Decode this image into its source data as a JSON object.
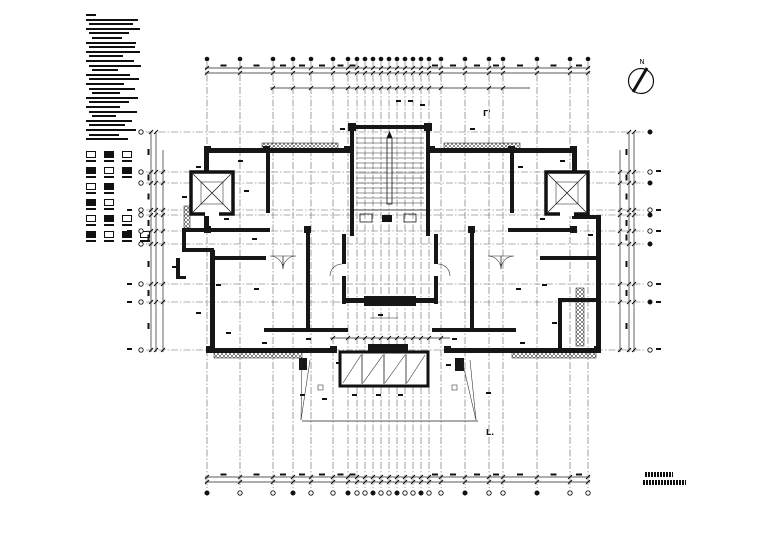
{
  "palette": {
    "bg": "#ffffff",
    "ink": "#161616",
    "grid": "#606060"
  },
  "labels": {
    "north": "N",
    "section_top": "Γ'",
    "section_bottom": "L."
  },
  "grid": {
    "vx": [
      207,
      240,
      273,
      293,
      311,
      333,
      348,
      357,
      365,
      373,
      381,
      389,
      397,
      405,
      413,
      421,
      429,
      441,
      465,
      489,
      503,
      537,
      570,
      588
    ],
    "hy": [
      132,
      172,
      183,
      210,
      215,
      231,
      244,
      284,
      302,
      350
    ],
    "v_top": 62,
    "v_bot": 488,
    "h_left": 146,
    "h_right": 646,
    "bubble_top_y": 59,
    "bubble_bot_y": 493,
    "bubble_left_x": 141,
    "bubble_right_x": 650
  },
  "dims": {
    "top": {
      "y1": 68,
      "y2": 73,
      "x1": 205,
      "x2": 590
    },
    "bottom": {
      "y1": 477,
      "y2": 482,
      "x1": 205,
      "x2": 590
    },
    "left": {
      "x1": 151,
      "x2": 156,
      "y1": 132,
      "y2": 352
    },
    "right": {
      "x1": 629,
      "x2": 634,
      "y1": 132,
      "y2": 352
    },
    "inner_top": {
      "y": 88,
      "x1": 270,
      "x2": 530
    },
    "inner_bottom": {
      "y": 338,
      "x1": 330,
      "x2": 450
    },
    "inner_left_x": 163,
    "inner_right_x": 620,
    "ramp_base": {
      "y": 421,
      "x1": 302,
      "x2": 478
    }
  },
  "stairs": {
    "x1": 356,
    "x2": 424,
    "y_start": 138,
    "count": 14,
    "step": 5
  },
  "bay": {
    "x": 340,
    "y": 352,
    "w": 88,
    "h": 34,
    "mullions": [
      362,
      384,
      406
    ]
  },
  "notes": {
    "lines": [
      [
        10,
        0
      ],
      [
        52,
        0
      ],
      [
        44,
        3
      ],
      [
        54,
        0
      ],
      [
        40,
        3
      ],
      [
        30,
        6
      ],
      [
        50,
        0
      ],
      [
        46,
        3
      ],
      [
        54,
        0
      ],
      [
        34,
        3
      ],
      [
        48,
        0
      ],
      [
        52,
        3
      ],
      [
        26,
        6
      ],
      [
        44,
        0
      ],
      [
        50,
        3
      ],
      [
        38,
        0
      ],
      [
        46,
        3
      ],
      [
        28,
        6
      ],
      [
        52,
        0
      ],
      [
        40,
        3
      ],
      [
        34,
        0
      ],
      [
        48,
        3
      ],
      [
        24,
        6
      ],
      [
        46,
        0
      ],
      [
        36,
        3
      ],
      [
        50,
        0
      ],
      [
        30,
        3
      ],
      [
        42,
        0
      ]
    ],
    "legend_rows": [
      3,
      3,
      2,
      2,
      3,
      4
    ]
  },
  "annots": [
    [
      196,
      166
    ],
    [
      238,
      160
    ],
    [
      182,
      196
    ],
    [
      244,
      190
    ],
    [
      224,
      218
    ],
    [
      252,
      238
    ],
    [
      172,
      266
    ],
    [
      216,
      284
    ],
    [
      254,
      288
    ],
    [
      196,
      312
    ],
    [
      226,
      332
    ],
    [
      262,
      342
    ],
    [
      306,
      338
    ],
    [
      336,
      362
    ],
    [
      300,
      394
    ],
    [
      322,
      398
    ],
    [
      352,
      394
    ],
    [
      376,
      394
    ],
    [
      398,
      394
    ],
    [
      446,
      364
    ],
    [
      486,
      392
    ],
    [
      452,
      338
    ],
    [
      516,
      288
    ],
    [
      542,
      284
    ],
    [
      560,
      258
    ],
    [
      586,
      300
    ],
    [
      552,
      322
    ],
    [
      520,
      342
    ],
    [
      560,
      160
    ],
    [
      518,
      166
    ],
    [
      584,
      190
    ],
    [
      540,
      218
    ],
    [
      588,
      234
    ],
    [
      470,
      128
    ],
    [
      396,
      100
    ],
    [
      408,
      100
    ],
    [
      420,
      104
    ],
    [
      340,
      128
    ],
    [
      378,
      314
    ],
    [
      127,
      170
    ],
    [
      127,
      209
    ],
    [
      127,
      230
    ],
    [
      127,
      283
    ],
    [
      127,
      301
    ],
    [
      127,
      348
    ],
    [
      656,
      170
    ],
    [
      656,
      209
    ],
    [
      656,
      230
    ],
    [
      656,
      283
    ],
    [
      656,
      301
    ],
    [
      656,
      348
    ]
  ],
  "title_bars": [
    {
      "x": 645,
      "y": 472,
      "w": 28
    },
    {
      "x": 643,
      "y": 480,
      "w": 43
    }
  ]
}
